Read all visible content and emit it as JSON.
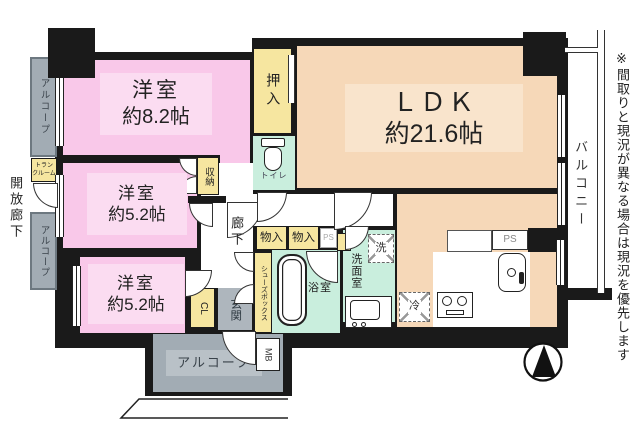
{
  "plan": {
    "rooms": {
      "bedroom1": {
        "name": "洋室",
        "size": "約8.2帖"
      },
      "bedroom2": {
        "name": "洋室",
        "size": "約5.2帖"
      },
      "bedroom3": {
        "name": "洋室",
        "size": "約5.2帖"
      },
      "ldk": {
        "name": "ＬＤＫ",
        "size": "約21.6帖"
      },
      "toilet": "トイレ",
      "bath": "浴室",
      "washroom": "洗面室",
      "corridor": "廊下",
      "entrance": "玄関"
    },
    "storage": {
      "oshiire": "押入",
      "shuno": "収納",
      "monoiri_a": "物入",
      "monoiri_b": "物入",
      "cl": "CL",
      "shoes_box": "シューズボックス",
      "trunk_room": "トランクルーム"
    },
    "fixtures": {
      "washer": "洗",
      "fridge": "冷",
      "mb": "MB",
      "ps_hall": "PS",
      "ps_kitchen": "PS"
    },
    "outside": {
      "alcove_left_upper": "アルコープ",
      "alcove_left_lower": "アルコープ",
      "alcove_entry": "アルコープ",
      "balcony": "バルコニー",
      "open_corridor": "開放廊下"
    },
    "disclaimer": "※間取りと現況が異なる場合は現況を優先します",
    "colors": {
      "bedroom": "#f9c8e9",
      "ldk": "#f6d8b8",
      "storage": "#f6e6a0",
      "wet_area": "#c9eedd",
      "alcove": "#a2acb4",
      "wall": "#1a1a1a"
    }
  }
}
